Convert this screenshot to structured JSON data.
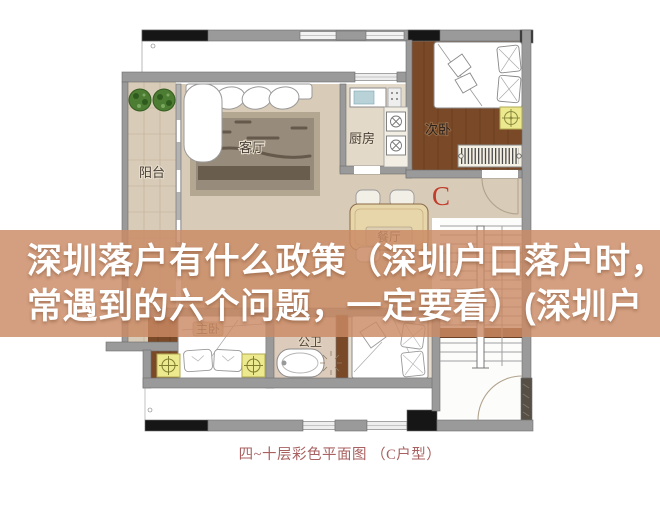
{
  "article_overlay": {
    "title_line1": "深圳落户有什么政策（深圳户口落户时，",
    "title_line2": "常遇到的六个问题，一定要看）(深圳户",
    "band_color": "#cb8a64",
    "text_color": "#ffffff"
  },
  "floorplan": {
    "caption": "四~十层彩色平面图 （C户型）",
    "unit_mark": "C",
    "room_labels": {
      "balcony": "阳台",
      "living_room": "客厅",
      "kitchen": "厨房",
      "secondary_bedroom": "次卧",
      "dining_room": "餐厅",
      "master_bedroom": "主卧",
      "bathroom": "公卫"
    },
    "colors": {
      "floor_beige": "#d8cbb7",
      "floor_light": "#e3d9c9",
      "wood_brown": "#7a4a28",
      "wall_gray": "#9a9a9a",
      "wall_black": "#161616",
      "unit_mark_red": "#c23b2b",
      "caption_red": "#a86060",
      "ac_unit_yellow": "#ece98f",
      "plant_green": "#4c7d33"
    }
  }
}
